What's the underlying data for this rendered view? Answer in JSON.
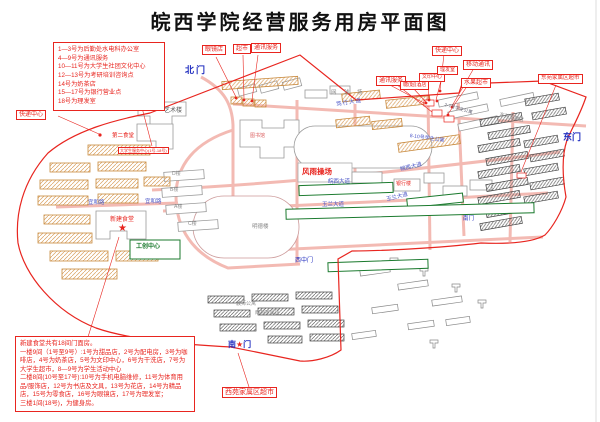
{
  "title": "皖西学院经营服务用房平面图",
  "legend_lines": [
    "1—3号为后勤处水电科办公室",
    "4—9号为通讯服务",
    "10—11号为大学生社团文化中心",
    "12—13号为考研培训咨询点",
    "14号为奶茶店",
    "15—17号为银行营业点",
    "18号为理发室"
  ],
  "note_lines": [
    "新建食堂共有18间门面房。",
    "一楼9间（1号至9号）:1号为甜品店，2号为配电房，3号为咖啡店，4号为奶茶店，5号为文印中心，6号为干洗店，7号为大学生超市，8—9号为学生活动中心",
    "二楼8间(10号至17号):10号为手机电脑维修，11号为体育用品/服饰店，12号为书店及文具，13号为花店，14号为精品店，15号为零食店，16号为眼镜店，17号为理发室；",
    "三楼1间(18号)，为健身房。"
  ],
  "labels": {
    "express_left": "快递中心",
    "glasses": "眼镜店",
    "market_top": "超市",
    "telecom_top": "通讯服务",
    "express_right": "快递中心",
    "mobile": "移动通讯",
    "telecom_right": "通讯服务",
    "print": "文印中心",
    "barber": "理发室",
    "tobacco": "糖(烟)酒店",
    "fruit": "水果超市",
    "east_market": "东苑家属区超市",
    "west_market": "西苑家属区超市",
    "north_gate": "北门",
    "east_gate": "东门",
    "south_gate_left": "南",
    "south_gate_right": "门",
    "south_gate_small": "南门",
    "west_mid_gate": "西中门",
    "duxing": "笃行大道",
    "wanxi": "皖西大道",
    "yulan": "玉兰大道",
    "yihe": "宜和路",
    "tennis": "网 球 场",
    "playground": "风雨操场",
    "art": "艺术楼",
    "library": "图书馆",
    "mingde": "明德楼",
    "bldg_d": "D楼",
    "bldg_b": "B楼",
    "bldg_a": "A楼",
    "bldg_c": "C楼",
    "second_canteen": "第二食堂",
    "new_canteen": "新建食堂",
    "service_center": "大学生服务中心(1号-18号)",
    "gongchuang": "工创中心",
    "bank": "银行楼",
    "apt27": "2-7号学生公寓",
    "apt810": "8-10号学生公寓",
    "east_family": "东苑家属区",
    "west_family": "西苑家属区",
    "teacher_apt": "教师公寓",
    "star": "★"
  },
  "colors": {
    "boundary_red": "#e8251f",
    "gate_blue": "#2330c0",
    "road_pink": "#f2b3ab",
    "green": "#1b7a2e",
    "tan": "#c8893c"
  }
}
